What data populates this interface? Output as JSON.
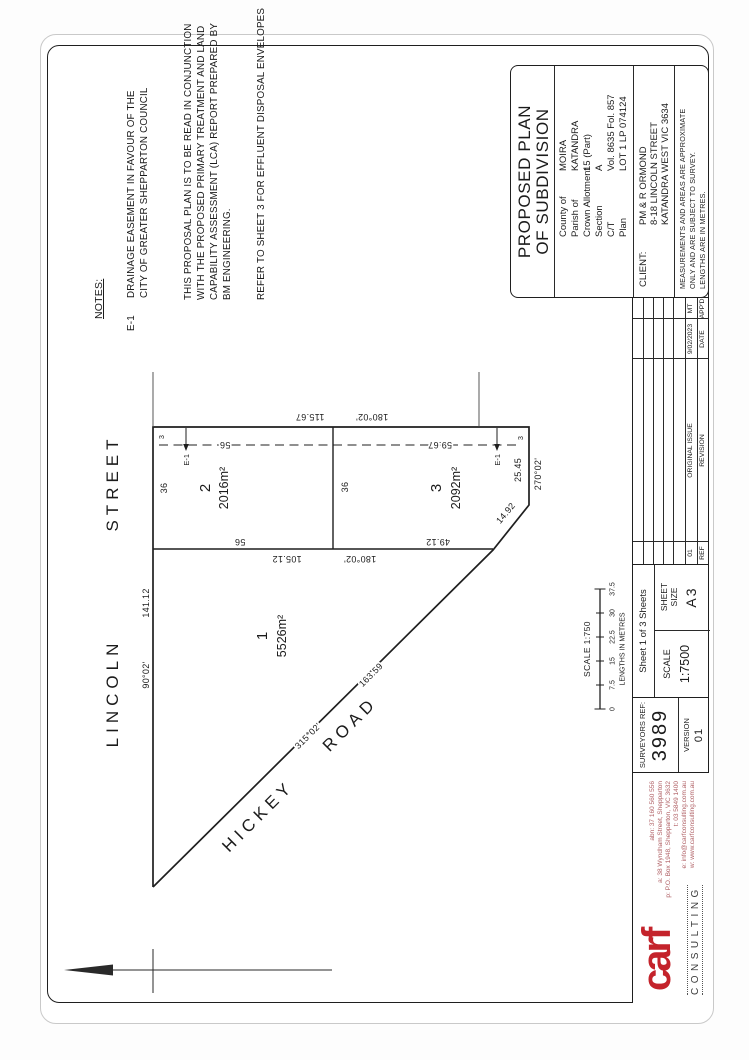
{
  "notes": {
    "heading": "NOTES:",
    "e1_ref": "E-1",
    "e1_lines": [
      "DRAINAGE EASEMENT IN FAVOUR OF THE",
      "CITY OF GREATER SHEPPARTON COUNCIL"
    ],
    "paragraph": [
      "THIS PROPOSAL PLAN IS TO BE READ IN CONJUNCTION",
      "WITH THE PROPOSED PRIMARY TREATMENT AND LAND",
      "CAPABILITY ASSESSMENT (LCA) REPORT PREPARED BY",
      "BM ENGINEERING."
    ],
    "refer": "REFER TO SHEET 3 FOR EFFLUENT DISPOSAL ENVELOPES"
  },
  "plan": {
    "streets": {
      "lincoln_a": "LINCOLN",
      "lincoln_b": "STREET",
      "hickey_a": "HICKEY",
      "hickey_b": "ROAD"
    },
    "lots": [
      {
        "num": "1",
        "area": "5526m²"
      },
      {
        "num": "2",
        "area": "2016m²"
      },
      {
        "num": "3",
        "area": "2092m²"
      }
    ],
    "dims": {
      "lot1_frontage": "141.12",
      "lot1_frontage_bearing": "90°02'",
      "lot1_east": "105.12",
      "lot1_east_bearing": "180°02'",
      "east_boundary": "115.67",
      "east_boundary_bearing": "180°02'",
      "lot2_frontage": "36",
      "lot3_frontage": "36",
      "lot2_side": "56",
      "lot3_side": "49.12",
      "ease_lot2": "56",
      "ease_lot3": "59.67",
      "lot3_south": "25.45",
      "lot3_south_bearing": "270°02'",
      "bevel": "14.92",
      "road_bearing": "315°02'",
      "road_length": "163.59",
      "ease_width_a": "3",
      "ease_width_b": "3",
      "easement_a": "E-1",
      "easement_b": "E-1"
    }
  },
  "scalebar": {
    "title": "SCALE 1:750",
    "ticks": [
      "0",
      "7.5",
      "15",
      "22.5",
      "30",
      "37.5"
    ],
    "units": "LENGTHS IN METRES"
  },
  "titleblock": {
    "title1": "PROPOSED PLAN",
    "title2": "OF SUBDIVISION",
    "property": [
      {
        "label": "County of",
        "value": "MOIRA"
      },
      {
        "label": "Parish of",
        "value": "KATANDRA"
      },
      {
        "label": "Crown Allotment",
        "value": "15 (Part)"
      },
      {
        "label": "Section",
        "value": "A"
      },
      {
        "label": "C/T",
        "value": "Vol. 8635 Fol. 857"
      },
      {
        "label": "Plan",
        "value": "LOT 1 LP 074124"
      }
    ],
    "client_label": "CLIENT:",
    "client_lines": [
      "PM & R ORMOND",
      "8-18 LINCOLN STREET",
      "KATANDRA WEST VIC 3634"
    ],
    "disclaimer": [
      "MEASUREMENTS AND AREAS ARE APPROXIMATE",
      "ONLY AND ARE SUBJECT TO SURVEY.",
      "LENGTHS ARE IN METRES."
    ]
  },
  "revision": {
    "headers": [
      "REF",
      "REVISION",
      "DATE",
      "APP'D"
    ],
    "row": [
      "01",
      "ORIGINAL ISSUE",
      "9/02/2023",
      "MT"
    ]
  },
  "sheetinfo": {
    "sheet": "Sheet 1 of 3 Sheets",
    "scale_label": "SCALE",
    "scale_value": "1:7500",
    "size_label_1": "SHEET",
    "size_label_2": "SIZE",
    "size_value": "A3"
  },
  "surveyor": {
    "ref_label": "SURVEYORS REF:",
    "ref_value": "3989",
    "version_label": "VERSION",
    "version_value": "01"
  },
  "brand": {
    "name": "carf",
    "subtitle": "CONSULTING",
    "accent": "#c4232b",
    "contacts": [
      "abn: 37 160 560 556",
      "a: 38 Wyndham Street, Shepparton",
      "p: P.O. Box 1948, Shepparton, VIC 3632",
      "t: 03 5849 1400",
      "e: info@carfconsulting.com.au",
      "w: www.carfconsulting.com.au"
    ]
  }
}
